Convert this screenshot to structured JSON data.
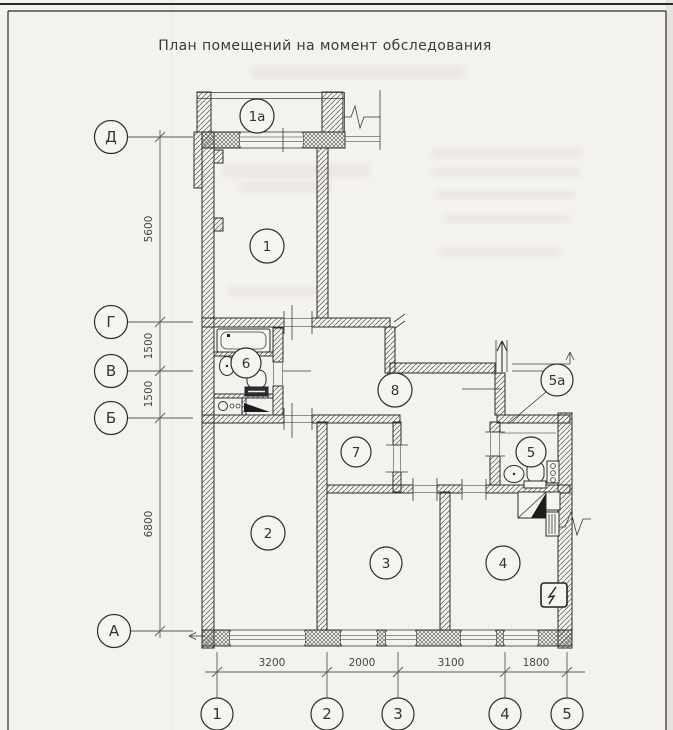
{
  "sheet": {
    "title": "План помещений на момент обследования"
  },
  "axes": {
    "row_labels": [
      "Д",
      "Г",
      "В",
      "Б",
      "А"
    ],
    "col_labels": [
      "1",
      "2",
      "3",
      "4",
      "5"
    ],
    "left_dims": [
      "5600",
      "1500",
      "1500",
      "6800"
    ],
    "bottom_dims": [
      "3200",
      "2000",
      "3100",
      "1800"
    ]
  },
  "plan": {
    "room_labels": [
      {
        "id": "1a",
        "label": "1а"
      },
      {
        "id": "1",
        "label": "1"
      },
      {
        "id": "6",
        "label": "6"
      },
      {
        "id": "8",
        "label": "8"
      },
      {
        "id": "5a",
        "label": "5а"
      },
      {
        "id": "5",
        "label": "5"
      },
      {
        "id": "7",
        "label": "7"
      },
      {
        "id": "2",
        "label": "2"
      },
      {
        "id": "3",
        "label": "3"
      },
      {
        "id": "4",
        "label": "4"
      }
    ]
  },
  "colors": {
    "paper": "#f4f2ee",
    "ink": "#2d2d2d",
    "window_frame_gray": "#8d8d8d",
    "ghost_bleed": "#8d7d68"
  }
}
